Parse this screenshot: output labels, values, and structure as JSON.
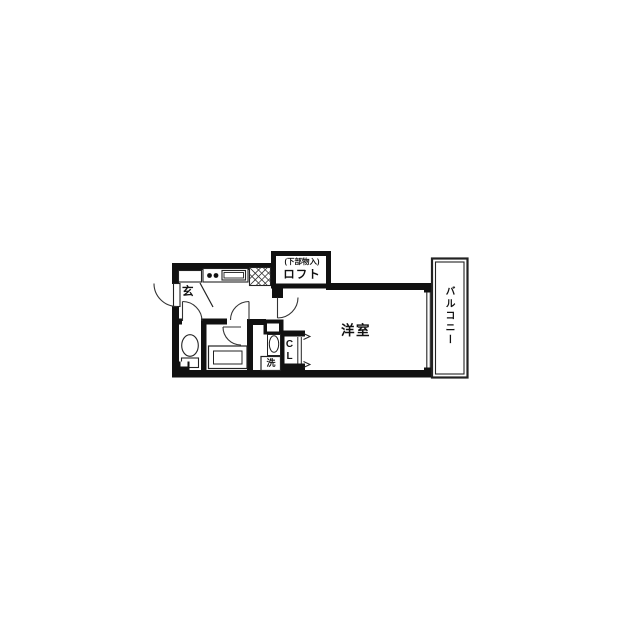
{
  "floorplan": {
    "labels": {
      "loft_note": "(下部物入)",
      "loft": "ロフト",
      "entrance": "玄",
      "room": "洋室",
      "closet": "CL",
      "washer": "洗",
      "balcony": "バルコニー"
    },
    "colors": {
      "wall": "#111111",
      "fixture_line": "#222222",
      "background": "#ffffff"
    }
  }
}
